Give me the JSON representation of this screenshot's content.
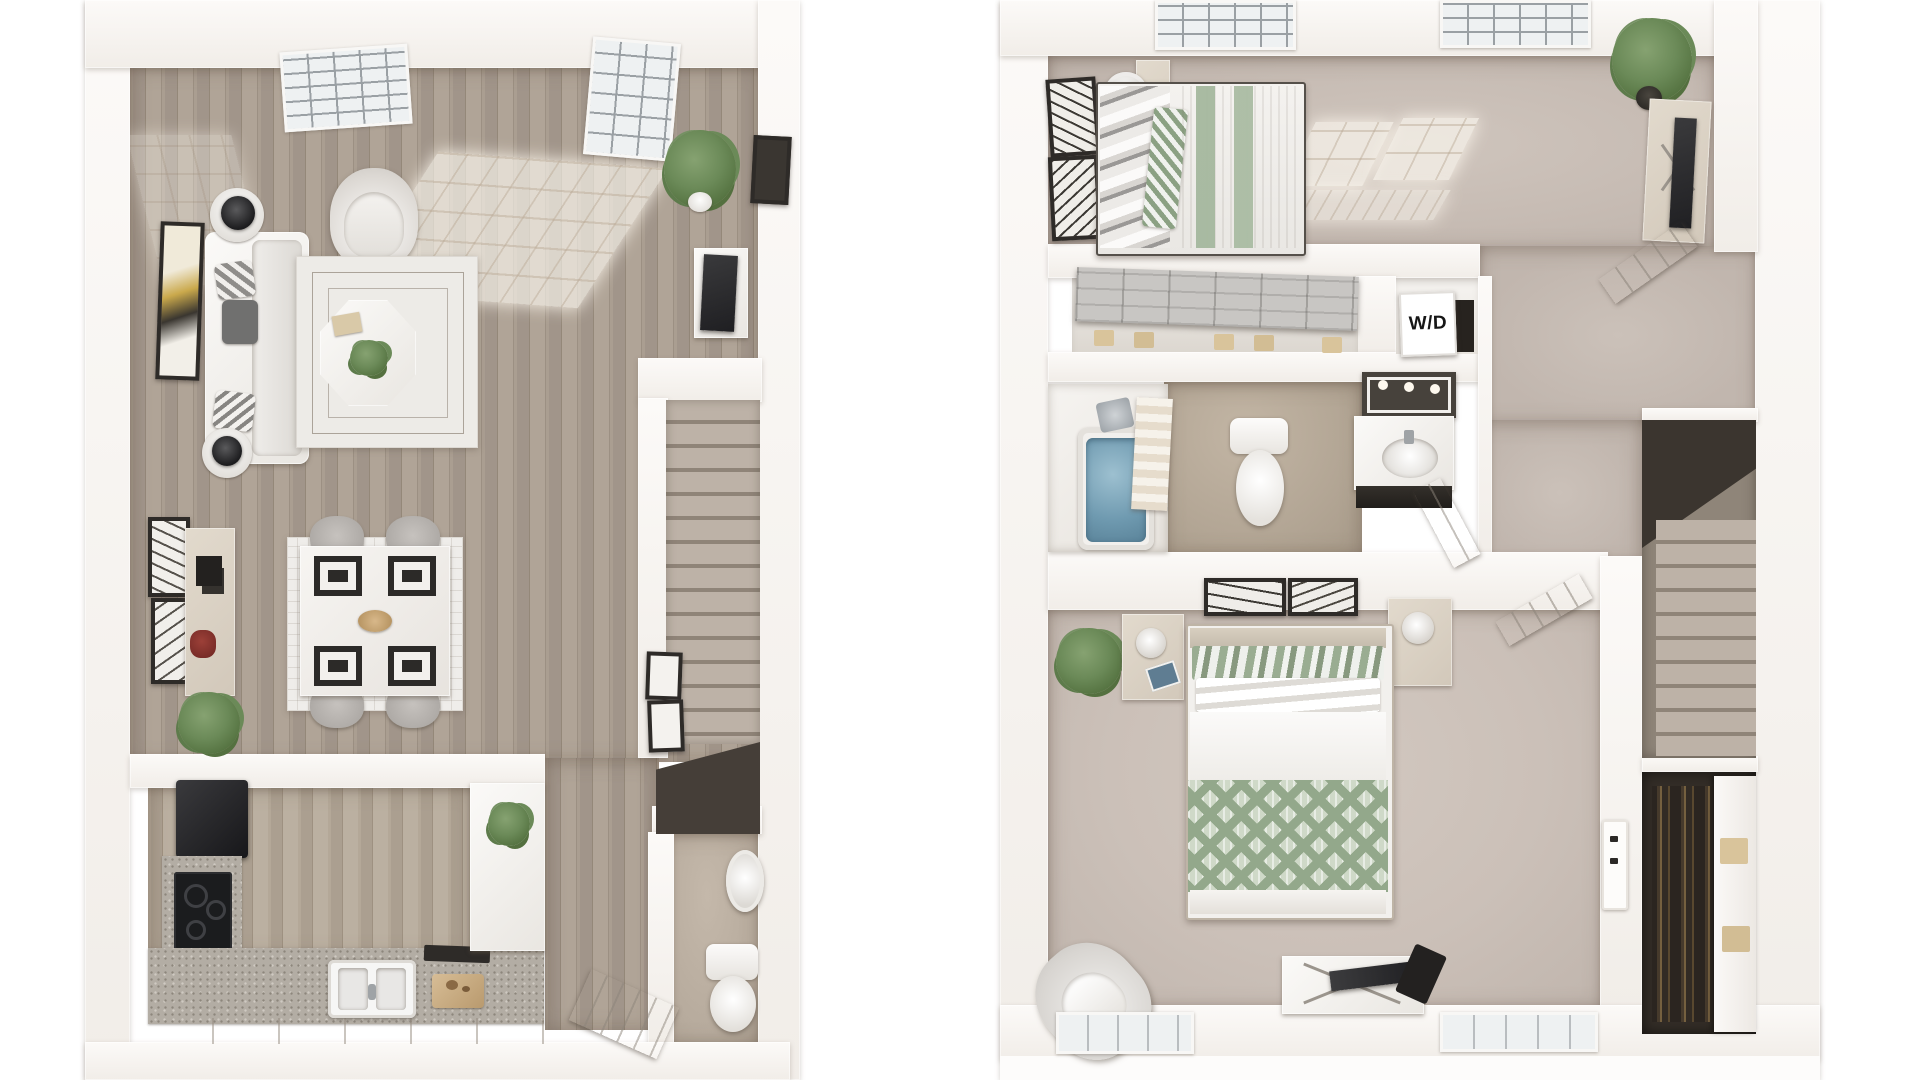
{
  "scene": {
    "type": "3d-floor-plan-rendering",
    "background_color": "#ffffff",
    "plans_count": 2,
    "view": "top-down dollhouse"
  },
  "labels": {
    "washer_dryer": "W/D"
  },
  "palette": {
    "wall": "#f5f2ee",
    "wall_shade": "#e6e1da",
    "wood_floor": "#a1958a",
    "wood_floor_light": "#b3a79b",
    "carpet_bedroom1": "#c6bbb3",
    "carpet_bedroom2": "#cbc0b8",
    "carpet_hall": "#c1b6ae",
    "bath_tile": "#b3a695",
    "halfbath_floor": "#b7ab9d",
    "stair_tread": "#bdb2a7",
    "stair_void": "#3b352f",
    "closet_dark": "#342d27",
    "sofa": "#e9e6e2",
    "rug": "#edebe7",
    "rug_line": "#8e8478",
    "accent_sage": "#a2b59b",
    "tub_water": "#7ba3b7",
    "appliance_black": "#1e1e20",
    "granite": "#b3ada4",
    "beige_furniture": "#d8cec1",
    "tv_screen": "#2b2b2d",
    "art_frame": "#2e2b28",
    "plant_green": "#6b8a58",
    "red_decor": "#7e2f2b"
  },
  "first_floor": {
    "name": "first-floor-plan",
    "rooms": [
      {
        "name": "living-room",
        "floor": "wood",
        "features": [
          "picture-window",
          "glass-entry-door",
          "sunlight-patches",
          "sofa-with-pillows",
          "wall-art",
          "two-side-tables-with-black-lamps",
          "armchair",
          "octagon-coffee-table-with-plant",
          "geometric-area-rug",
          "tv-console",
          "tv",
          "round-black-speaker",
          "wall-mirror",
          "potted-plant"
        ]
      },
      {
        "name": "dining-area",
        "floor": "wood",
        "features": [
          "dining-table",
          "four-gray-chairs",
          "black-placemats",
          "patterned-rug",
          "sideboard",
          "two-abstract-artworks",
          "red-bowl",
          "potted-plant"
        ]
      },
      {
        "name": "kitchen",
        "floor": "wood",
        "features": [
          "black-refrigerator",
          "granite-counters",
          "black-cooktop",
          "double-sink",
          "cutting-board",
          "peninsula-counter",
          "small-plant"
        ]
      },
      {
        "name": "half-bathroom",
        "floor": "tile",
        "features": [
          "pedestal-sink",
          "toilet",
          "open-door"
        ]
      },
      {
        "name": "staircase",
        "features": [
          "treads",
          "gallery-frames",
          "dark-landing"
        ]
      }
    ]
  },
  "second_floor": {
    "name": "second-floor-plan",
    "rooms": [
      {
        "name": "bedroom-1",
        "floor": "carpet",
        "features": [
          "bed-sage-striped-duvet",
          "gray-pillows",
          "wall-art",
          "floor-lamp",
          "two-windows",
          "sunlight-patch",
          "monstera-plant",
          "dresser-with-tv",
          "open-door"
        ]
      },
      {
        "name": "reach-in-closet",
        "features": [
          "sliding-doors",
          "shoe-boxes"
        ]
      },
      {
        "name": "laundry-closet",
        "label": "W/D"
      },
      {
        "name": "bathroom",
        "floor": "tile",
        "features": [
          "filled-bathtub",
          "shower-screen",
          "toilet",
          "vanity-with-mirror",
          "door"
        ]
      },
      {
        "name": "hallway-landing",
        "floor": "carpet",
        "features": [
          "open-door",
          "staircase-down"
        ]
      },
      {
        "name": "bedroom-2",
        "floor": "carpet",
        "features": [
          "bed-chevron-blanket",
          "two-nightstands-with-lamps",
          "wall-art",
          "potted-plant",
          "accent-chair",
          "tv-console",
          "light-switch-panel",
          "two-windows"
        ]
      },
      {
        "name": "walk-in-closet",
        "features": [
          "hanging-clothes",
          "sliding-panel"
        ]
      }
    ]
  }
}
